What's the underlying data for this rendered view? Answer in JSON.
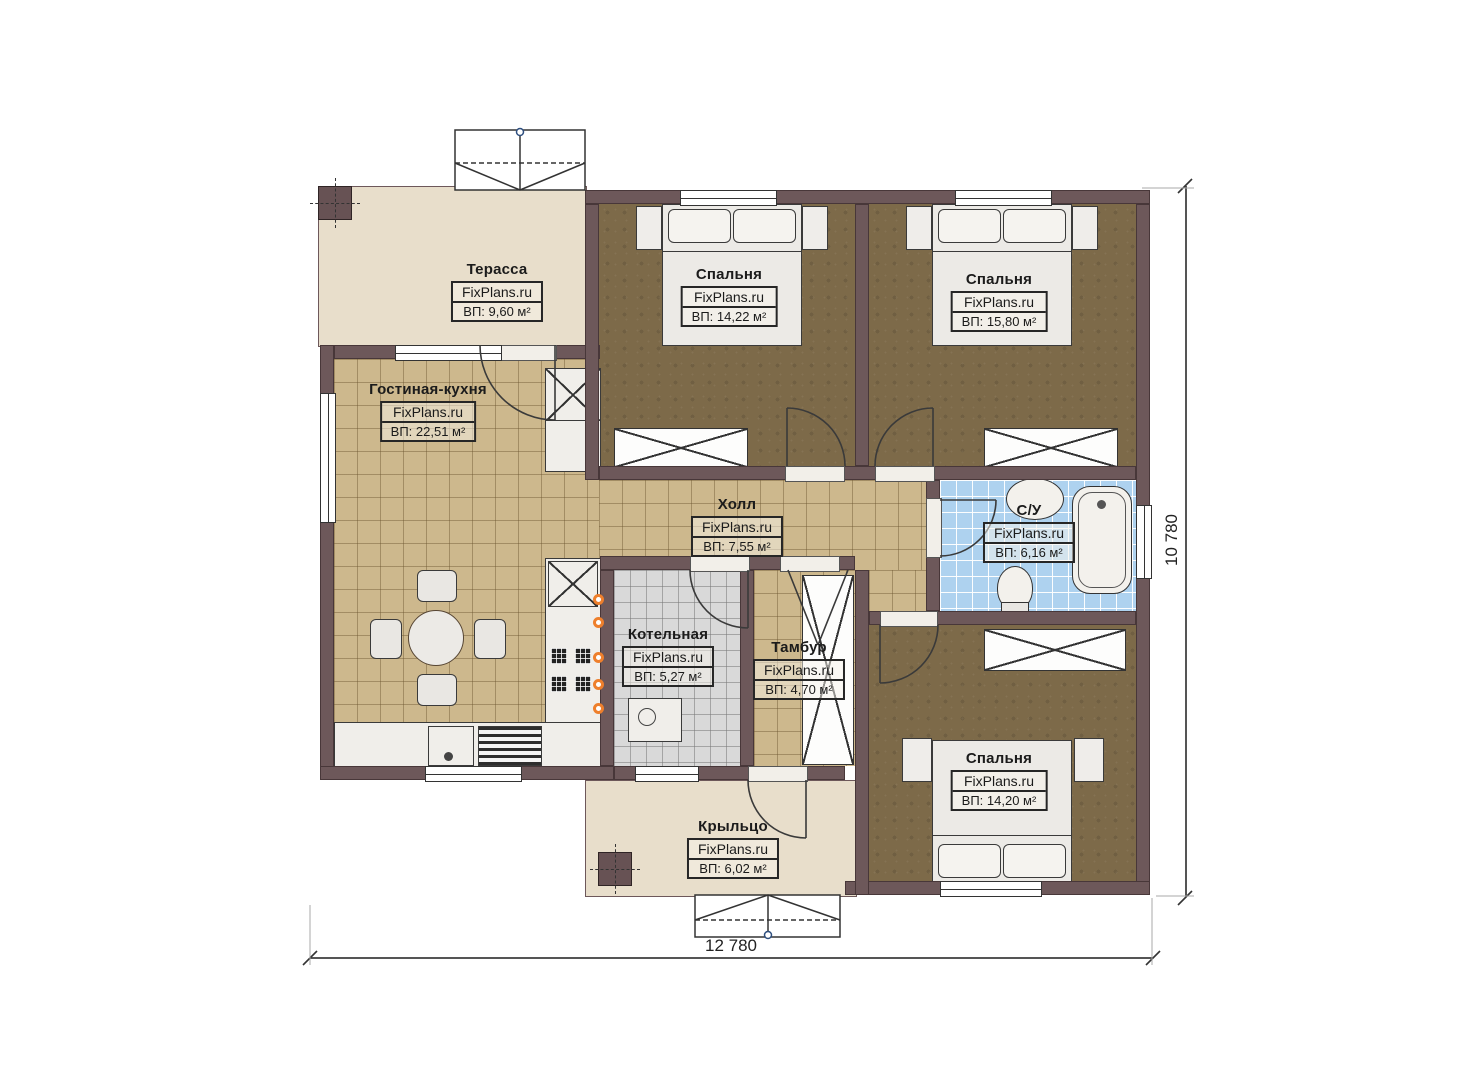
{
  "watermark": "FixPlans.ru",
  "rooms": [
    {
      "key": "terrace",
      "name": "Терасса",
      "area": "ВП: 9,60 м²"
    },
    {
      "key": "living-kitchen",
      "name": "Гостиная-кухня",
      "area": "ВП: 22,51 м²"
    },
    {
      "key": "bedroom-1",
      "name": "Спальня",
      "area": "ВП: 14,22 м²"
    },
    {
      "key": "bedroom-2",
      "name": "Спальня",
      "area": "ВП: 15,80 м²"
    },
    {
      "key": "hall",
      "name": "Холл",
      "area": "ВП: 7,55 м²"
    },
    {
      "key": "bathroom",
      "name": "С/У",
      "area": "ВП: 6,16 м²"
    },
    {
      "key": "boiler-room",
      "name": "Котельная",
      "area": "ВП: 5,27 м²"
    },
    {
      "key": "vestibule",
      "name": "Тамбур",
      "area": "ВП: 4,70 м²"
    },
    {
      "key": "bedroom-3",
      "name": "Спальня",
      "area": "ВП: 14,20 м²"
    },
    {
      "key": "porch",
      "name": "Крыльцо",
      "area": "ВП: 6,02 м²"
    }
  ],
  "dimensions": {
    "width_label": "12 780",
    "height_label": "10 780"
  },
  "colors": {
    "wall": "#6d585a",
    "deck_floor": "#e8decb",
    "tile_floor": "#cdb88d",
    "bedroom_floor": "#7d6a49",
    "bathroom_floor": "#aed2ef",
    "boiler_floor": "#d9d9d9",
    "accent_orange": "#ee7f2c"
  }
}
